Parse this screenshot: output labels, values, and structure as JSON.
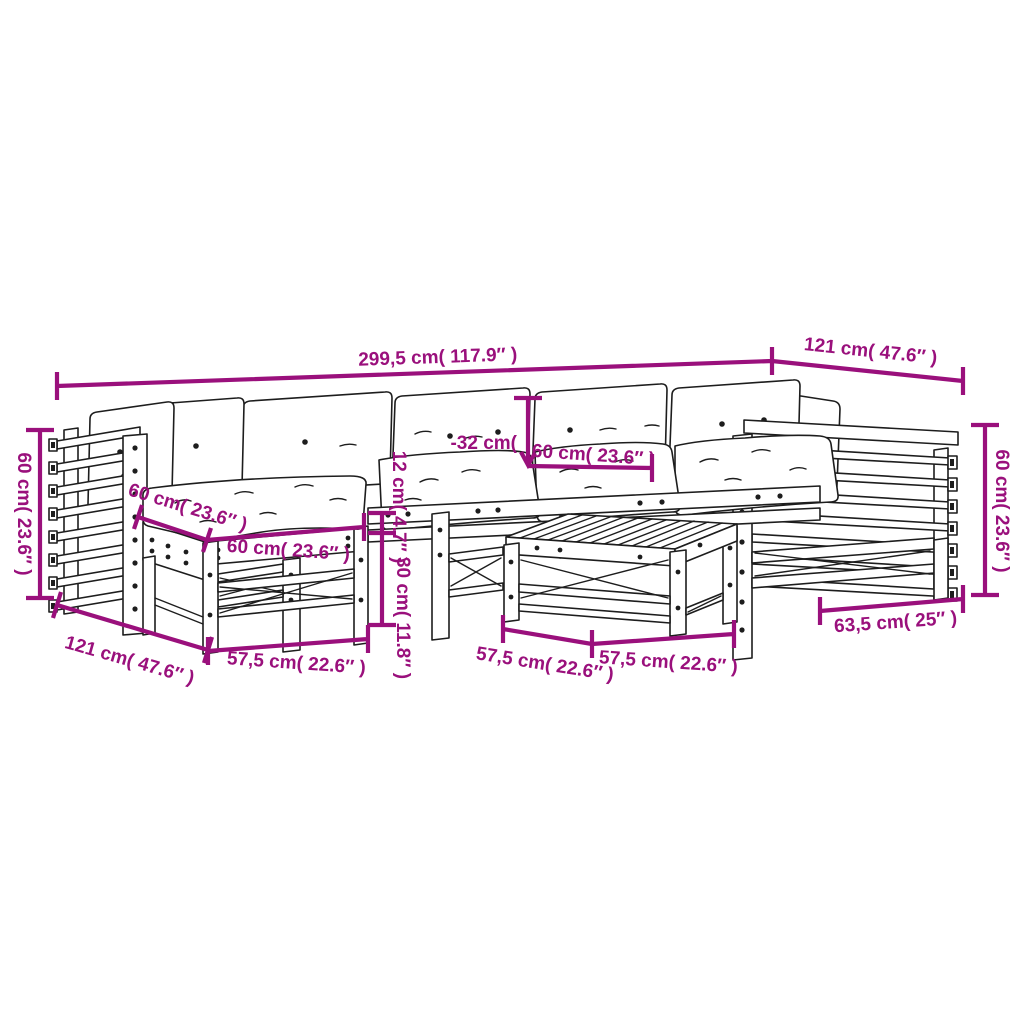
{
  "page": {
    "background": "#ffffff"
  },
  "colors": {
    "dimension": "#9a107c",
    "artwork": "#1d1d1d"
  },
  "diagram": {
    "type": "furniture-dimension-diagram",
    "subject": "garden lounge set with cushions: corner sofas, middle sections, footstool and slatted coffee table",
    "annotations": {
      "overall_width": "299,5 cm( 117.9″ )",
      "right_module_depth": "121 cm( 47.6″ )",
      "left_arm_height": "60 cm( 23.6″ )",
      "right_arm_height": "60 cm( 23.6″ )",
      "back_cushion_height": "-32 cm(",
      "seat_cushion_width": "60 cm( 23.6″ )",
      "cushion_thickness": "12 cm( 4.7″ )",
      "frame_height": "30 cm( 11.8″ )",
      "stool_cushion_depth": "60 cm( 23.6″ )",
      "stool_cushion_width": "60 cm( 23.6″ )",
      "left_module_depth": "121 cm( 47.6″ )",
      "stool_frame_width": "57,5 cm( 22.6″ )",
      "table_frame_width": "57,5 cm( 22.6″ )",
      "right_module_frame_width": "57,5 cm( 22.6″ )",
      "table_top_width": "63,5 cm( 25″ )"
    }
  }
}
